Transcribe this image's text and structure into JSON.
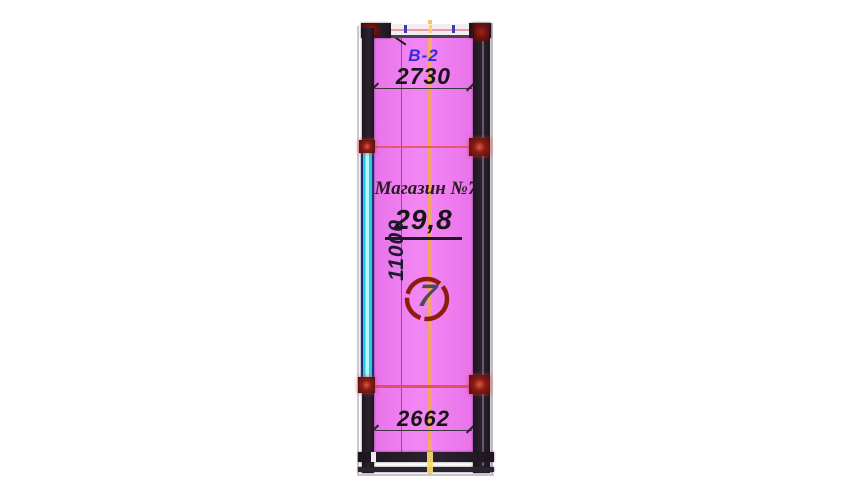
{
  "plan": {
    "unit_label": "В-2",
    "room_name": "Магазин №7",
    "area": "29,8",
    "room_number": "7",
    "dimensions": {
      "top_width": "2730",
      "left_height": "11000",
      "bottom_width": "2662"
    }
  },
  "colors": {
    "room_fill": "#ef7ff0",
    "wall": "#251c27",
    "window_glazing": "#2bc9db",
    "window_frame": "#1d2f6e",
    "junction_maroon": "#6a1210",
    "axis_centerline": "#f3a85c",
    "red_marker_line": "#e25454",
    "dimension_text": "#181418",
    "unit_label_text": "#2d2dd9",
    "room_number_circle": "#8c1c0c",
    "room_number_text": "#4c4c58"
  }
}
